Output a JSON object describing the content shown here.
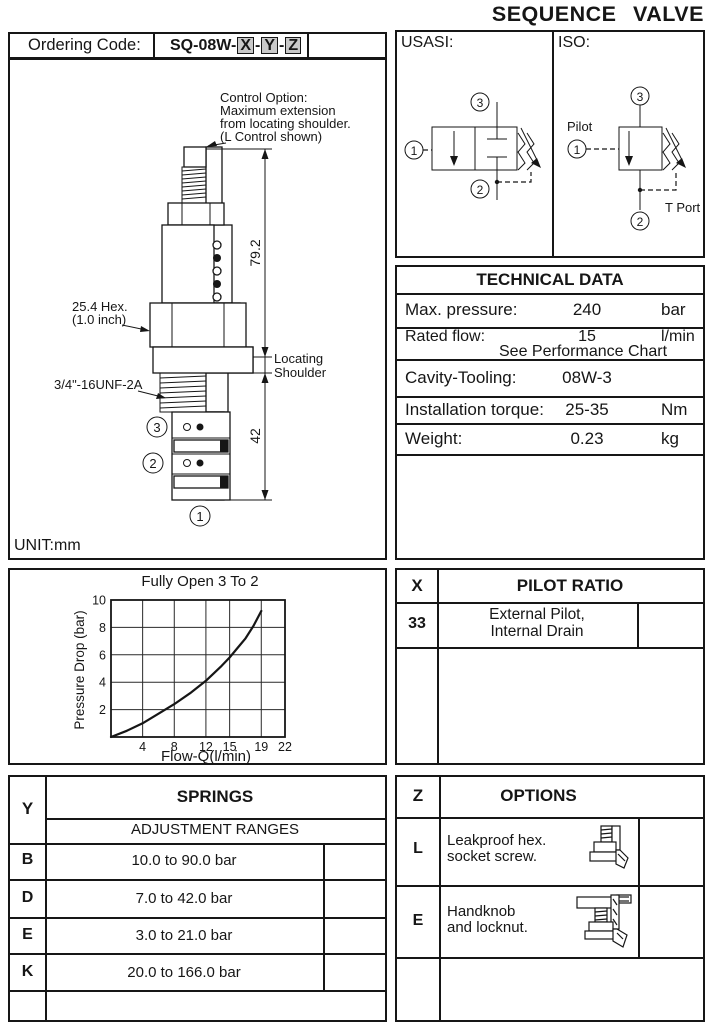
{
  "title": "SEQUENCE VALVE",
  "ordering": {
    "label": "Ordering Code:",
    "prefix": "SQ-08W-",
    "sep": "-",
    "x": "X",
    "y": "Y",
    "z": "Z"
  },
  "drawing": {
    "control_note_1": "Control Option:",
    "control_note_2": "Maximum extension",
    "control_note_3": "from locating shoulder.",
    "control_note_4": "(L Control shown)",
    "hex_label_1": "25.4 Hex.",
    "hex_label_2": "(1.0 inch)",
    "thread_label": "3/4\"-16UNF-2A",
    "dim_upper": "79.2",
    "dim_lower": "42",
    "shoulder_label_1": "Locating",
    "shoulder_label_2": "Shoulder",
    "port1": "1",
    "port2": "2",
    "port3": "3",
    "unit": "UNIT:mm"
  },
  "symbols": {
    "usasi_label": "USASI:",
    "iso_label": "ISO:",
    "pilot_label": "Pilot",
    "tport_label": "T Port",
    "p1": "1",
    "p2": "2",
    "p3": "3"
  },
  "technical_data": {
    "title": "TECHNICAL DATA",
    "rows": [
      {
        "label": "Max. pressure:",
        "value": "240",
        "unit": "bar"
      },
      {
        "label": "Rated flow:",
        "value": "15",
        "unit": "l/min"
      },
      {
        "label": "",
        "value": "See Performance Chart",
        "unit": ""
      },
      {
        "label": "Cavity-Tooling:",
        "value": "08W-3",
        "unit": ""
      },
      {
        "label": "Installation torque:",
        "value": "25-35",
        "unit": "Nm"
      },
      {
        "label": "Weight:",
        "value": "0.23",
        "unit": "kg"
      }
    ]
  },
  "chart_data": {
    "type": "line",
    "title": "Fully Open 3 To 2",
    "xlabel": "Flow-Q(l/min)",
    "ylabel": "Pressure Drop (bar)",
    "xlim": [
      0,
      22
    ],
    "ylim": [
      0,
      10
    ],
    "x_ticks": [
      4,
      8,
      12,
      15,
      19,
      22
    ],
    "y_ticks": [
      2,
      4,
      6,
      8,
      10
    ],
    "grid": true,
    "series": [
      {
        "name": "pressure-drop-fully-open-3-to-2",
        "x": [
          0,
          2,
          4,
          6,
          8,
          10,
          12,
          14,
          15,
          16,
          17,
          18,
          19
        ],
        "y": [
          0,
          0.45,
          1.0,
          1.7,
          2.4,
          3.2,
          4.1,
          5.2,
          5.8,
          6.5,
          7.2,
          8.1,
          9.2
        ]
      }
    ]
  },
  "pilot_ratio": {
    "col_key": "X",
    "title": "PILOT RATIO",
    "rows": [
      {
        "key": "33",
        "desc_1": "External Pilot,",
        "desc_2": "Internal Drain"
      }
    ]
  },
  "springs": {
    "col_key": "Y",
    "title": "SPRINGS",
    "subtitle": "ADJUSTMENT RANGES",
    "rows": [
      {
        "key": "B",
        "range": "10.0  to 90.0 bar"
      },
      {
        "key": "D",
        "range": "7.0  to  42.0 bar"
      },
      {
        "key": "E",
        "range": "3.0  to  21.0 bar"
      },
      {
        "key": "K",
        "range": "20.0  to  166.0 bar"
      }
    ]
  },
  "options": {
    "col_key": "Z",
    "title": "OPTIONS",
    "rows": [
      {
        "key": "L",
        "desc_1": "Leakproof hex.",
        "desc_2": "socket screw.",
        "icon": "hex-socket-screw-icon"
      },
      {
        "key": "E",
        "desc_1": "Handknob",
        "desc_2": "and locknut.",
        "icon": "handknob-locknut-icon"
      }
    ]
  }
}
